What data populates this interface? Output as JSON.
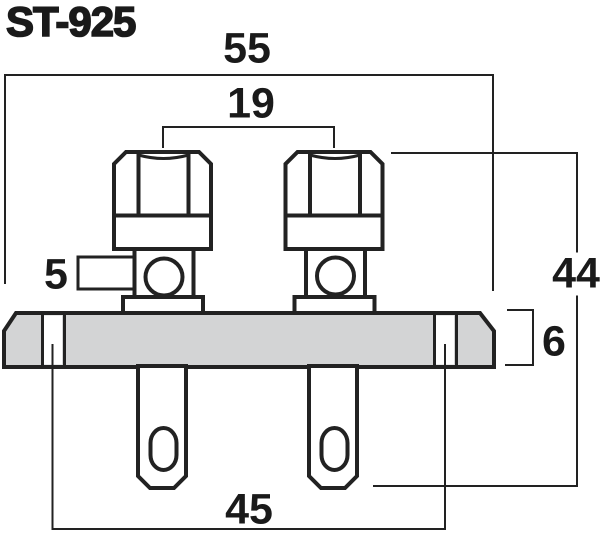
{
  "title": "ST-925",
  "colors": {
    "line": "#222222",
    "plate_fill": "#d3d4d5",
    "background": "#ffffff",
    "text": "#1a1a1a"
  },
  "dimensions": {
    "overall_width_mm": "55",
    "post_spacing_mm": "19",
    "tab_mm": "5",
    "overall_height_mm": "44",
    "plate_thickness_mm": "6",
    "hole_spacing_mm": "45"
  }
}
